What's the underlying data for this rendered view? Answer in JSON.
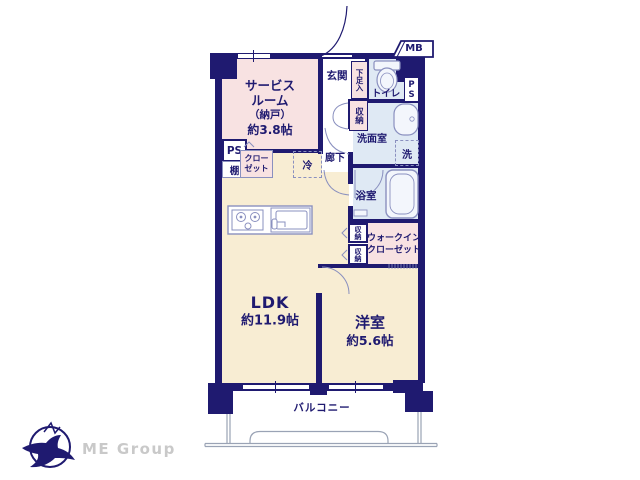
{
  "palette": {
    "wall": "#1f1a70",
    "pink": "#f8e2e2",
    "cream": "#f8edd3",
    "blue": "#dfe9f4",
    "fixture": "#8a90bf",
    "rail": "#9aa3b5",
    "logo_gray": "#c9c9c9"
  },
  "labels": {
    "service_room": {
      "l1": "サービス",
      "l2": "ルーム",
      "l3": "（納戸）",
      "l4": "約3.8帖"
    },
    "genkan": "玄関",
    "shoe": "下足入",
    "toilet": "トイレ",
    "ps": "PS",
    "mb": "MB",
    "storage": "収納",
    "washroom": "洗面室",
    "washer": "洗",
    "bathroom": "浴室",
    "corridor": "廊下",
    "fridge": "冷",
    "shelf": "棚",
    "closet": {
      "l1": "クロー",
      "l2": "ゼット"
    },
    "wic": {
      "l1": "ウォークイン",
      "l2": "クローゼット"
    },
    "ldk": {
      "l1": "LDK",
      "l2": "約11.9帖"
    },
    "western": {
      "l1": "洋室",
      "l2": "約5.6帖"
    },
    "balcony": "バルコニー",
    "logo_text": "ME Group"
  },
  "icons": {
    "toilet": "toilet-icon",
    "vanity": "sink-icon",
    "bathtub": "bathtub-icon",
    "stove": "stove-icon",
    "kitchen_sink": "kitchen-sink-icon",
    "door_arcs": "door-swing-icon",
    "railing": "balcony-railing",
    "logo": "bird-logo-icon"
  }
}
